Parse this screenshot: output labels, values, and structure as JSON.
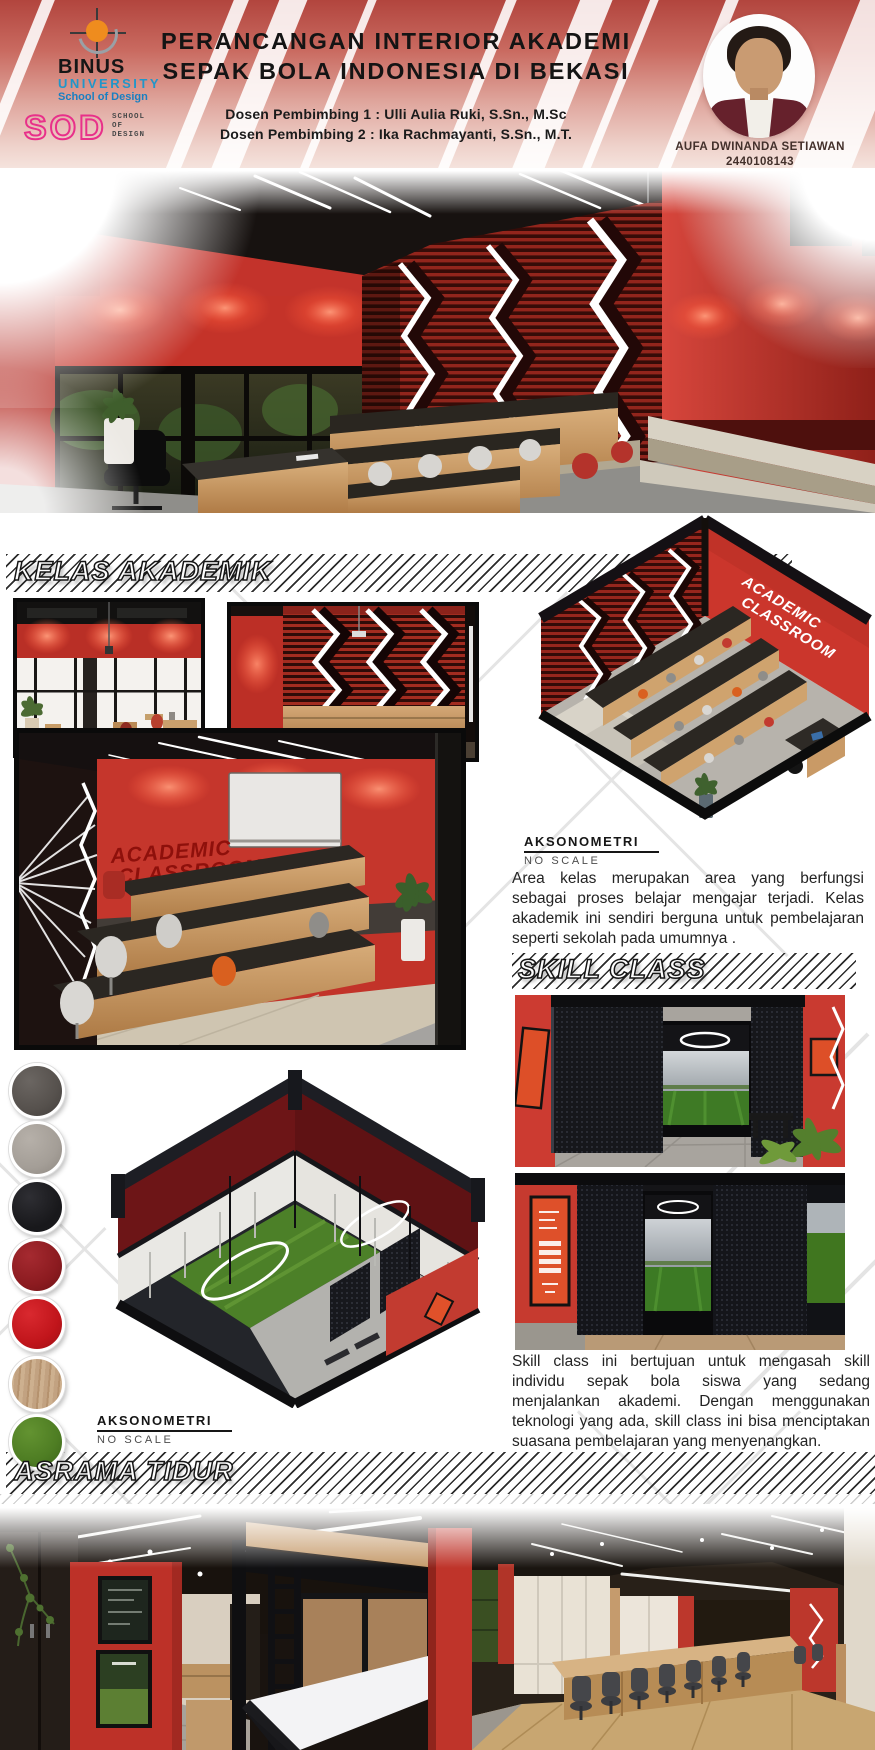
{
  "header": {
    "binus_logo": {
      "name": "BINUS",
      "line2": "UNIVERSITY",
      "line3": "School of Design"
    },
    "sod_logo": {
      "acronym": "SOD",
      "w1": "SCHOOL",
      "w2": "OF",
      "w3": "DESIGN"
    },
    "title1": "PERANCANGAN INTERIOR AKADEMI",
    "title2": "SEPAK BOLA INDONESIA DI BEKASI",
    "advisor1": "Dosen Pembimbing 1 : Ulli Aulia Ruki, S.Sn., M.Sc",
    "advisor2": "Dosen Pembimbing 2 : Ika Rachmayanti, S.Sn., M.T.",
    "student_name": "AUFA DWINANDA SETIAWAN",
    "student_id": "2440108143"
  },
  "kelas_akademik": {
    "heading": "KELAS AKADEMIK",
    "elevation1": {
      "label": "ELEVATION",
      "scale": "NO SCALE"
    },
    "elevation2": {
      "label": "ELEVATION",
      "scale": "NO SCALE"
    },
    "aksonometri": {
      "label": "AKSONOMETRI",
      "scale": "NO SCALE"
    },
    "sign_line1": "ACADEMIC",
    "sign_line2": "CLASSROOM",
    "paragraph": "Area kelas merupakan area yang berfungsi sebagai proses belajar mengajar terjadi. Kelas akademik ini sendiri berguna untuk pembelajaran seperti sekolah pada umumnya ."
  },
  "skill_class": {
    "heading": "SKILL CLASS",
    "aksonometri": {
      "label": "AKSONOMETRI",
      "scale": "NO SCALE"
    },
    "paragraph": "Skill class ini bertujuan untuk mengasah skill individu sepak bola siswa yang sedang menjalankan akademi. Dengan menggunakan teknologi yang ada, skill class ini bisa menciptakan suasana pembelajaran yang menyenangkan."
  },
  "asrama_tidur": {
    "heading": "ASRAMA TIDUR"
  },
  "materials": {
    "items": [
      {
        "name": "dark-grey-fabric",
        "color": "#56514d"
      },
      {
        "name": "light-grey-fabric",
        "color": "#a49e97"
      },
      {
        "name": "black-matte",
        "color": "#18181b"
      },
      {
        "name": "dark-red",
        "color": "#8c1b20"
      },
      {
        "name": "red",
        "color": "#c1151b"
      },
      {
        "name": "light-wood",
        "color": "#c2a281"
      },
      {
        "name": "grass-turf",
        "color": "#4e7d23"
      }
    ]
  },
  "colors": {
    "accent_red": "#c43a30",
    "maroon": "#6d1517",
    "wood": "#c49a67",
    "binus_blue": "#2196c9",
    "sod_magenta": "#e8308a",
    "header_gradient_top": "#b2453e",
    "header_gradient_bottom": "#f5e3dd"
  }
}
